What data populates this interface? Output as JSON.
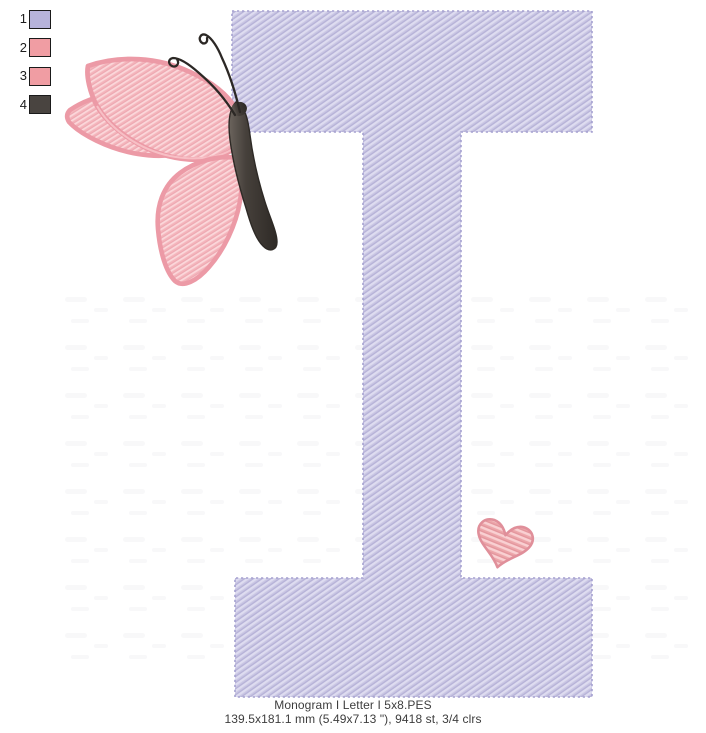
{
  "window": {
    "background": "#ffffff",
    "width": 706,
    "height": 733
  },
  "legend": {
    "items": [
      {
        "number": "1",
        "color": "#b7b3db",
        "name": "lavender thread"
      },
      {
        "number": "2",
        "color": "#f09da3",
        "name": "pink thread"
      },
      {
        "number": "3",
        "color": "#f09da3",
        "name": "pink thread"
      },
      {
        "number": "4",
        "color": "#494440",
        "name": "dark gray thread"
      }
    ],
    "swatch_border": "#1a1a1a"
  },
  "design": {
    "letter": "I",
    "colors": {
      "letter_fill": "#c9c6e3",
      "letter_fill_light": "#dedcf0",
      "letter_fill_dark": "#b4b0d6",
      "letter_outline": "#a5a1d0",
      "wing_fill": "#f4b5bc",
      "wing_fill_light": "#fbd7da",
      "wing_fill_dark": "#eda7b0",
      "wing_border": "#ec9aa6",
      "wing_border_light": "#f8c3c9",
      "body_fill": "#46403b",
      "body_outline": "#2e2a26",
      "body_highlight": "#6b645d",
      "antenna": "#2c2825",
      "heart_fill": "#eca6aa",
      "heart_stripe_light": "#f9d0d2",
      "heart_stripe_dark": "#e2949c",
      "heart_border": "#e08f9a",
      "watermark": "#7a7a96"
    }
  },
  "caption": {
    "line1": "Monogram I Letter I 5x8.PES",
    "line2": "139.5x181.1 mm (5.49x7.13 \"), 9418 st, 3/4 clrs"
  }
}
